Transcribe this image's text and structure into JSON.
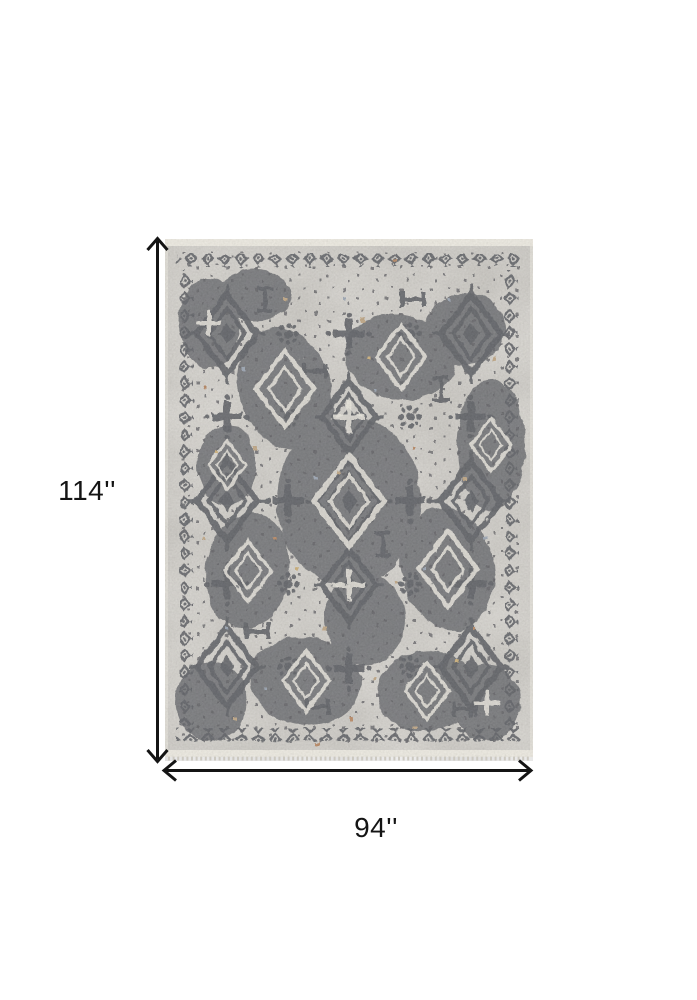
{
  "page": {
    "background": "#ffffff"
  },
  "product_image": {
    "subject": "Distressed traditional oriental area rug in gray and charcoal with taupe, rust and blue accents",
    "orientation": "portrait"
  },
  "dimension_annotations": {
    "height": {
      "label": "114''"
    },
    "width": {
      "label": "94''"
    },
    "line_color": "#141414"
  },
  "palette": {
    "charcoal": "#3e4046",
    "ground": "#ccc9c1",
    "ivory": "#e7e4da",
    "selvedge": "#eae7dd",
    "ink": "#141414",
    "tan": "#b2946c",
    "rust": "#a96f44",
    "blue": "#8692a3",
    "gold": "#c2a061"
  }
}
